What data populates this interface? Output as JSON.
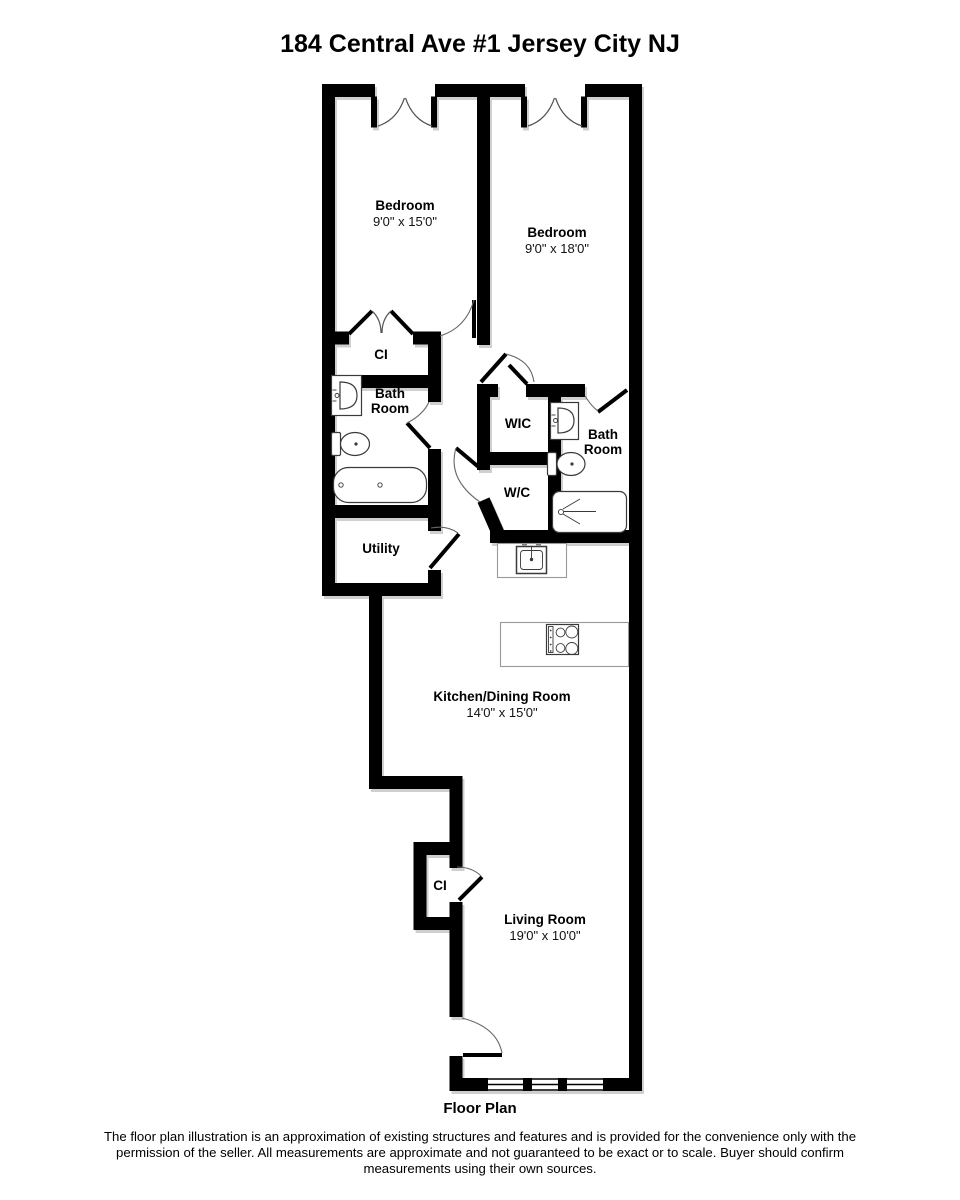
{
  "page": {
    "title": "184 Central Ave #1 Jersey City NJ",
    "caption": "Floor Plan",
    "disclaimer_lines": [
      "The floor plan illustration is an approximation of existing structures and features and is provided for the convenience only with the",
      "permission of the seller. All measurements are approximate and not guaranteed to be exact or to scale. Buyer should confirm",
      "measurements using their own sources."
    ]
  },
  "rooms": {
    "bedroom_left": {
      "name": "Bedroom",
      "dims": "9'0\" x 15'0\""
    },
    "bedroom_right": {
      "name": "Bedroom",
      "dims": "9'0\" x 18'0\""
    },
    "closet_upper": {
      "name": "CI"
    },
    "bathroom_left": {
      "name_lines": [
        "Bath",
        "Room"
      ]
    },
    "wic": {
      "name": "WIC"
    },
    "bathroom_right": {
      "name_lines": [
        "Bath",
        "Room"
      ]
    },
    "wc": {
      "name": "W/C"
    },
    "utility": {
      "name": "Utility"
    },
    "kitchen_dining": {
      "name": "Kitchen/Dining Room",
      "dims": "14'0\" x 15'0\""
    },
    "closet_living": {
      "name": "CI"
    },
    "living_room": {
      "name": "Living Room",
      "dims": "19'0\" x 10'0\""
    }
  },
  "fixtures": [
    "pedestal-sink",
    "toilet",
    "bathtub",
    "shower",
    "kitchen-sink",
    "cooktop-island",
    "double-casement-window",
    "triple-window",
    "bifold-closet-door",
    "entry-door"
  ],
  "colors": {
    "wall": "#000000",
    "wall_shadow": "#cfcfcf",
    "counter_outline": "#999999",
    "fixture_outline": "#3a3a3a",
    "background": "#ffffff",
    "text": "#000000"
  }
}
